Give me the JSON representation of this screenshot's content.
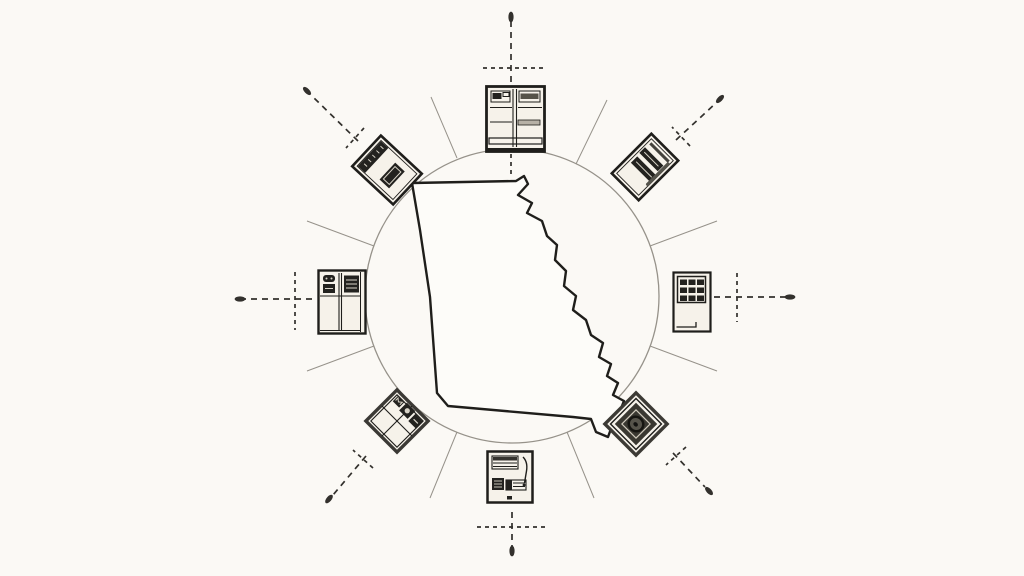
{
  "meta": {
    "type": "hand-drawn concept diagram",
    "description": "Outline map of the U.S. state of Georgia centered inside a thin circle, ringed by eight sketched appliance and document icons placed at compass points. Each icon has a dashed crosshair arrow radiating outward ending in a small dot tip, with thin solid rays fanning out between the icons. No text is rendered anywhere in the image."
  },
  "colors": {
    "background": "#fbf9f5",
    "ink": "#1f1e1b",
    "light_stroke": "#96928a",
    "dash_stroke": "#33312d",
    "icon_fill": "#f6f2ea",
    "icon_dark": "#23221f",
    "accent_gray": "#b7b1a6",
    "map_fill": "#fdfcf9"
  },
  "center": {
    "name": "georgia-state-outline",
    "kind": "state silhouette map",
    "enclosure": "thin circle"
  },
  "nodes": [
    {
      "direction": "north",
      "icon": "double-door-cabinet-icon"
    },
    {
      "direction": "north-east",
      "icon": "tilted-ledger-card-icon"
    },
    {
      "direction": "east",
      "icon": "keypad-panel-icon"
    },
    {
      "direction": "south-east",
      "icon": "seal-stamp-diamond-icon"
    },
    {
      "direction": "south",
      "icon": "striped-document-card-icon"
    },
    {
      "direction": "south-west",
      "icon": "quadrant-diamond-icon"
    },
    {
      "direction": "west",
      "icon": "appliance-panel-icon"
    },
    {
      "direction": "north-west",
      "icon": "tilted-document-icon"
    }
  ],
  "arrows": {
    "count": 8,
    "style": "dashed line with perpendicular crosshair tick and filled dot tip",
    "directions": [
      "N",
      "NE",
      "E",
      "SE",
      "S",
      "SW",
      "W",
      "NW"
    ]
  },
  "rays": {
    "count": 8,
    "style": "thin solid radiating lines between icons"
  }
}
